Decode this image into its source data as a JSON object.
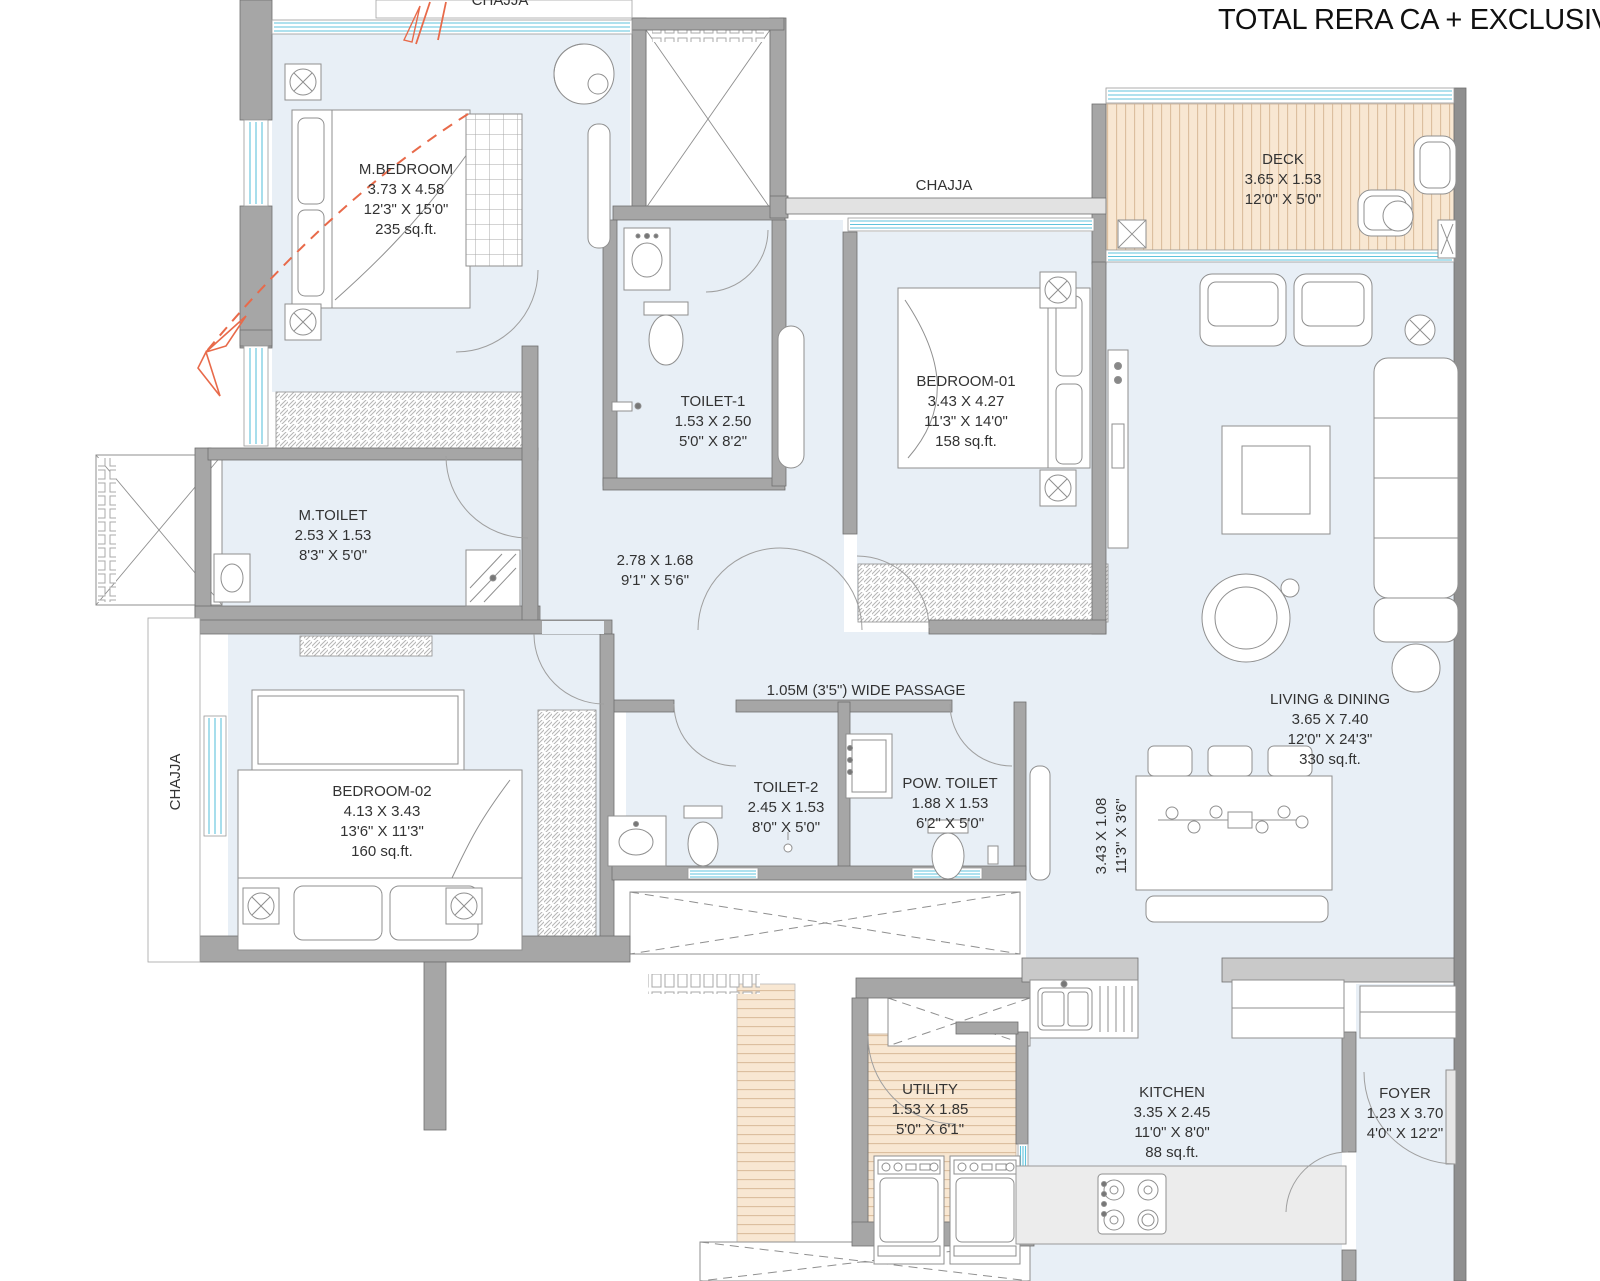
{
  "title": "TOTAL RERA CA + EXCLUSIVE CA",
  "labels": {
    "chajja_top": "CHAJJA",
    "chajja_mid": "CHAJJA",
    "chajja_left": "CHAJJA",
    "wide_passage": "1.05M (3'5\") WIDE PASSAGE",
    "passage_dim_m": "2.78 X 1.68",
    "passage_dim_ft": "9'1\" X 5'6\"",
    "side_dim_m": "3.43 X 1.08",
    "side_dim_ft": "11'3\" X 3'6\""
  },
  "rooms": {
    "m_bedroom": {
      "name": "M.BEDROOM",
      "dim_m": "3.73 X 4.58",
      "dim_ft": "12'3\" X 15'0\"",
      "area": "235 sq.ft."
    },
    "toilet1": {
      "name": "TOILET-1",
      "dim_m": "1.53 X 2.50",
      "dim_ft": "5'0\" X 8'2\""
    },
    "bedroom01": {
      "name": "BEDROOM-01",
      "dim_m": "3.43 X 4.27",
      "dim_ft": "11'3\" X 14'0\"",
      "area": "158 sq.ft."
    },
    "deck": {
      "name": "DECK",
      "dim_m": "3.65 X 1.53",
      "dim_ft": "12'0\" X 5'0\""
    },
    "m_toilet": {
      "name": "M.TOILET",
      "dim_m": "2.53 X 1.53",
      "dim_ft": "8'3\" X 5'0\""
    },
    "living_dining": {
      "name": "LIVING & DINING",
      "dim_m": "3.65 X 7.40",
      "dim_ft": "12'0\" X 24'3\"",
      "area": "330 sq.ft."
    },
    "bedroom02": {
      "name": "BEDROOM-02",
      "dim_m": "4.13 X 3.43",
      "dim_ft": "13'6\" X 11'3\"",
      "area": "160 sq.ft."
    },
    "toilet2": {
      "name": "TOILET-2",
      "dim_m": "2.45 X 1.53",
      "dim_ft": "8'0\" X 5'0\""
    },
    "pow_toilet": {
      "name": "POW. TOILET",
      "dim_m": "1.88 X 1.53",
      "dim_ft": "6'2\" X 5'0\""
    },
    "utility": {
      "name": "UTILITY",
      "dim_m": "1.53 X 1.85",
      "dim_ft": "5'0\" X 6'1\""
    },
    "kitchen": {
      "name": "KITCHEN",
      "dim_m": "3.35 X 2.45",
      "dim_ft": "11'0\" X 8'0\"",
      "area": "88 sq.ft."
    },
    "foyer": {
      "name": "FOYER",
      "dim_m": "1.23 X 3.70",
      "dim_ft": "4'0\" X 12'2\""
    }
  },
  "colors": {
    "room_fill": "#e8eff6",
    "wall": "#a6a6a6",
    "deck_fill": "#f8e7d2",
    "window_line": "#5fc3dc",
    "arrow": "#e86a4a"
  }
}
